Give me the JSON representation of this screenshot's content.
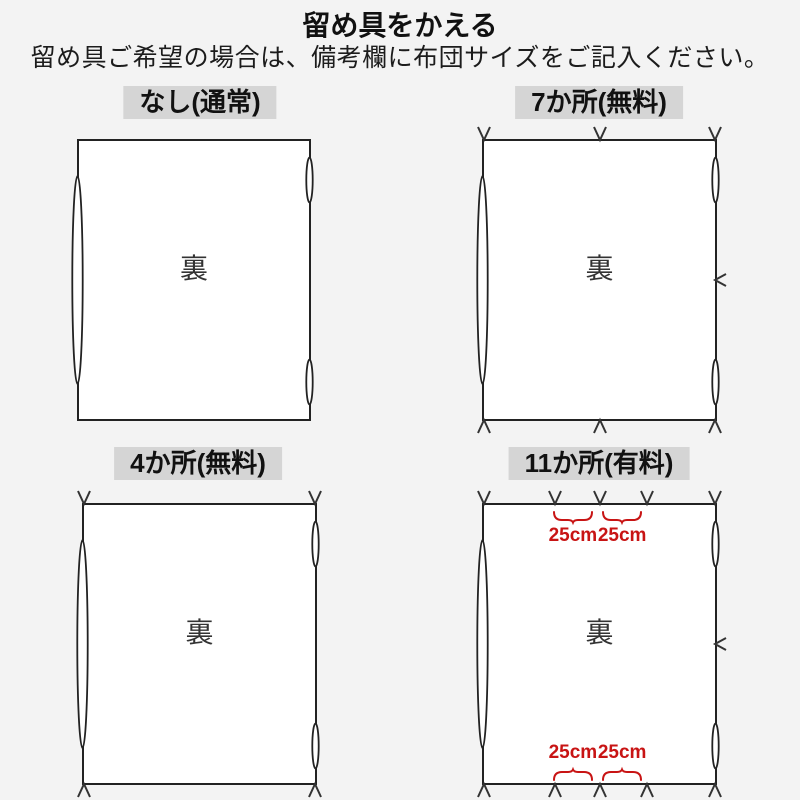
{
  "title": "留め具をかえる",
  "subtitle": "留め具ご希望の場合は、備考欄に布団サイズをご記入ください。",
  "colors": {
    "background": "#f3f3f3",
    "header_band": "#d5d5d5",
    "line": "#222222",
    "back_text": "#333333",
    "accent_red": "#c81414",
    "sheet_fill": "#ffffff"
  },
  "panels": [
    {
      "id": "none",
      "label": "なし(通常)",
      "back_label": "裏",
      "fastener_count": 0,
      "marks": {
        "top": [],
        "bottom": [],
        "right": []
      },
      "measurements": {
        "top": [],
        "bottom": []
      }
    },
    {
      "id": "seven",
      "label": "7か所(無料)",
      "back_label": "裏",
      "fastener_count": 7,
      "marks": {
        "top": [
          0,
          50,
          100
        ],
        "bottom": [
          0,
          50,
          100
        ],
        "right": [
          50
        ]
      },
      "measurements": {
        "top": [],
        "bottom": []
      }
    },
    {
      "id": "four",
      "label": "4か所(無料)",
      "back_label": "裏",
      "fastener_count": 4,
      "marks": {
        "top": [
          0,
          100
        ],
        "bottom": [
          0,
          100
        ],
        "right": []
      },
      "measurements": {
        "top": [],
        "bottom": []
      }
    },
    {
      "id": "eleven",
      "label": "11か所(有料)",
      "back_label": "裏",
      "fastener_count": 11,
      "marks": {
        "top": [
          0,
          30.6,
          50.2,
          70.6,
          100
        ],
        "bottom": [
          0,
          30.6,
          50.2,
          70.6,
          100
        ],
        "right": [
          50
        ]
      },
      "measurements": {
        "top": [
          {
            "x_pct": 38.5,
            "label": "25cm"
          },
          {
            "x_pct": 59.8,
            "label": "25cm"
          }
        ],
        "bottom": [
          {
            "x_pct": 38.5,
            "label": "25cm"
          },
          {
            "x_pct": 59.8,
            "label": "25cm"
          }
        ]
      }
    }
  ]
}
